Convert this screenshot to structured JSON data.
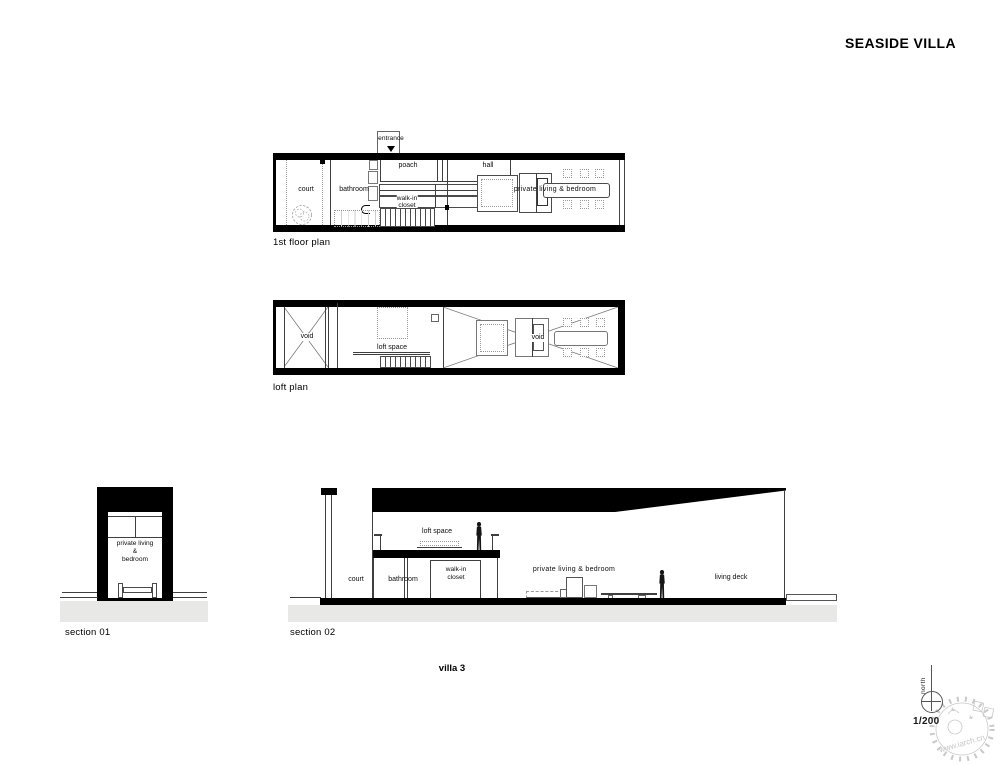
{
  "title": "SEASIDE VILLA",
  "fp": {
    "caption": "1st floor plan",
    "entrance": "entrance",
    "court": "court",
    "bathroom": "bathroom",
    "poach": "poach",
    "hall": "hall",
    "walkin1": "walk-in",
    "walkin2": "closet",
    "living": "private living & bedroom"
  },
  "lp": {
    "caption": "loft plan",
    "void_left": "void",
    "void_right": "void",
    "loft_space": "loft space"
  },
  "s1": {
    "caption": "section 01",
    "living1": "private living",
    "living2": "&",
    "living3": "bedroom"
  },
  "s2": {
    "caption": "section 02",
    "court": "court",
    "bathroom": "bathroom",
    "walkin1": "walk-in",
    "walkin2": "closet",
    "loft_space": "loft space",
    "living": "private living & bedroom",
    "living_deck": "living deck"
  },
  "footer": {
    "drawing_title": "villa 3",
    "scale": "1/200",
    "north": "north",
    "watermark": "www.iarch.cn"
  },
  "colors": {
    "wall": "#000000",
    "line": "#444444",
    "ground": "#e8e8e6",
    "watermark": "#c9c9c9"
  }
}
